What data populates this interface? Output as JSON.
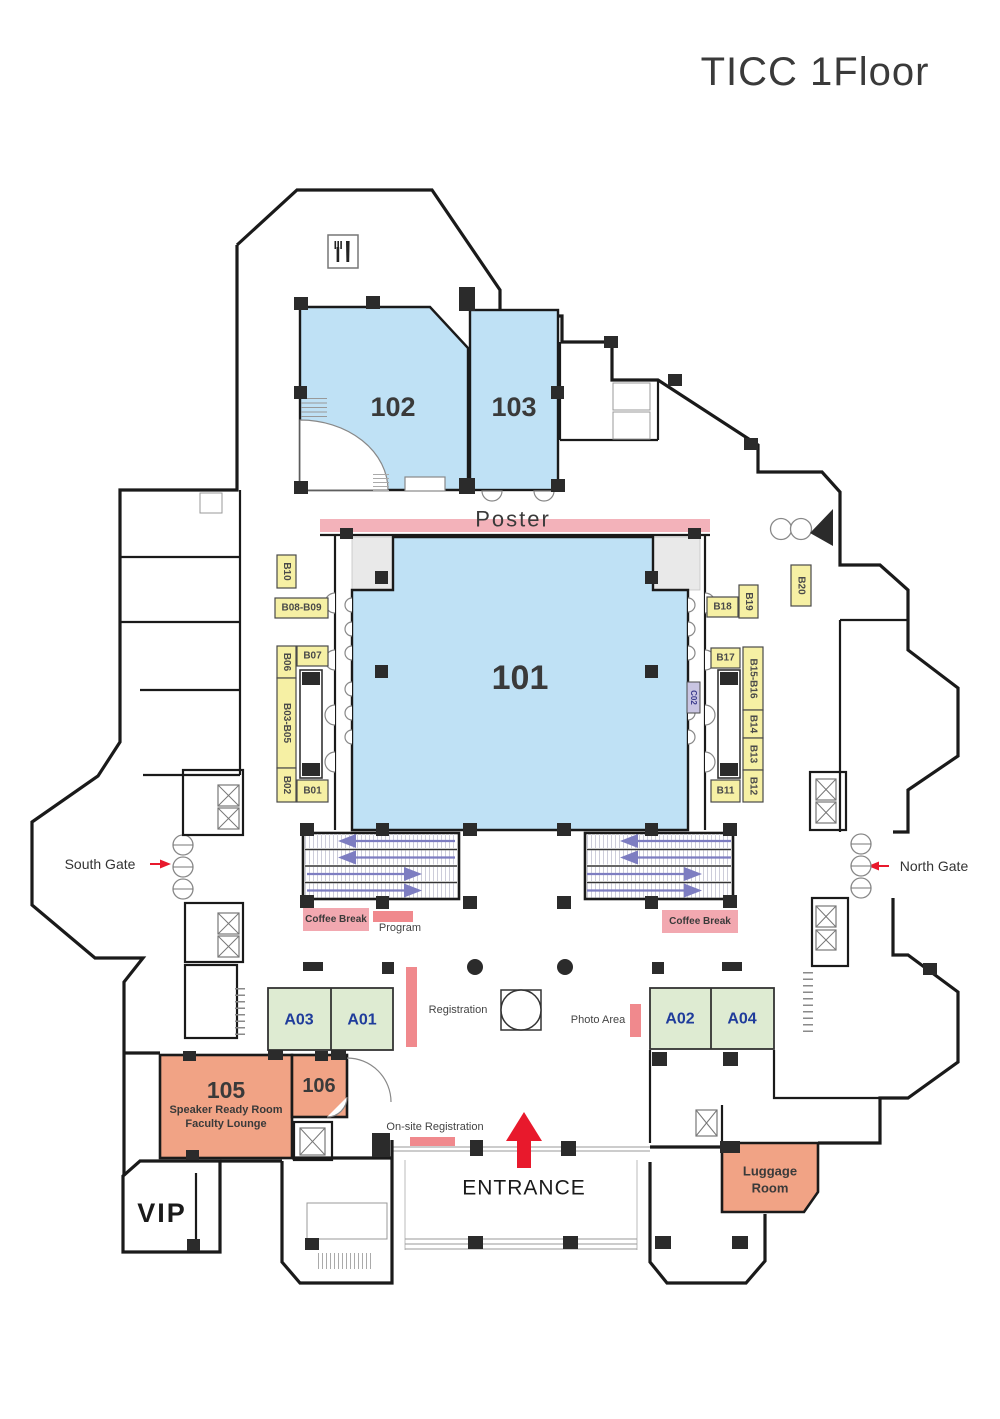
{
  "title": "TICC 1Floor",
  "rooms": {
    "r101": "101",
    "r102": "102",
    "r103": "103",
    "r105": "105",
    "r105_sub1": "Speaker Ready Room",
    "r105_sub2": "Faculty Lounge",
    "r106": "106",
    "vip": "VIP",
    "a01": "A01",
    "a02": "A02",
    "a03": "A03",
    "a04": "A04",
    "luggage_line1": "Luggage",
    "luggage_line2": "Room"
  },
  "booths": {
    "b01": "B01",
    "b02": "B02",
    "b03_05": "B03-B05",
    "b06": "B06",
    "b07": "B07",
    "b08_09": "B08-B09",
    "b10": "B10",
    "b11": "B11",
    "b12": "B12",
    "b13": "B13",
    "b14": "B14",
    "b15_16": "B15-B16",
    "b17": "B17",
    "b18": "B18",
    "b19": "B19",
    "b20": "B20",
    "c02": "C02"
  },
  "labels": {
    "poster": "Poster",
    "south_gate": "South Gate",
    "north_gate": "North Gate",
    "coffee_break_left": "Coffee Break",
    "coffee_break_right": "Coffee Break",
    "program": "Program",
    "registration": "Registration",
    "photo_area": "Photo Area",
    "onsite_registration": "On-site Registration",
    "entrance": "ENTRANCE"
  },
  "colors": {
    "wall": "#1A1A1A",
    "room_blue": "#BFE1F5",
    "corner_gray": "#E9E9E9",
    "booth_yellow": "#F6F0A4",
    "c02_lavender": "#C9C5E2",
    "green": "#DEEBD2",
    "orange": "#F1A385",
    "bar_pink": "#F0898D",
    "label_pink": "#F2A8B0",
    "poster_pink": "#F3B2BA",
    "red": "#E8192C",
    "escalator_arrow": "#7D7DC1",
    "room_label_blue": "#1F3C9B"
  }
}
